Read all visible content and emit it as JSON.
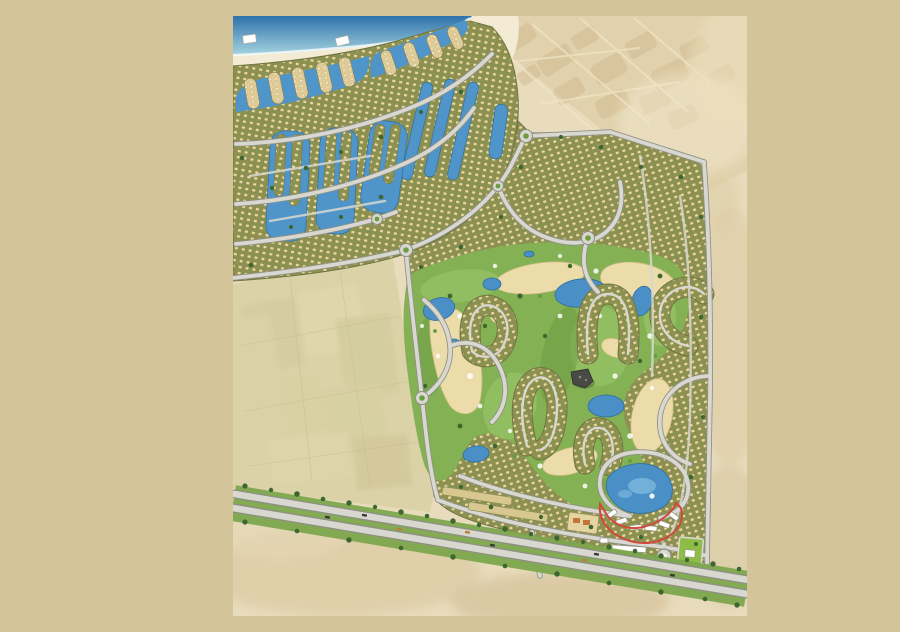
{
  "scene": {
    "type": "illustrated-masterplan-map",
    "description": "Painted aerial master plan of a coastal golf-resort community: beach and lagoon villages at the north, a central golf course threaded through residential loops, vacant farmland to the west, desert around, a highway along the south edge and a red-outlined hotel crescent near the main entrance",
    "features": [
      {
        "id": "sea",
        "name": "sea"
      },
      {
        "id": "beach",
        "name": "beach"
      },
      {
        "id": "beach-cabanas",
        "name": "beach cabanas",
        "count": 2
      },
      {
        "id": "existing-development-faded",
        "name": "faded existing development"
      },
      {
        "id": "desert",
        "name": "desert"
      },
      {
        "id": "north-lagoon-village",
        "name": "north lagoon village"
      },
      {
        "id": "beach-lagoons",
        "name": "beach lagoons with finger homes"
      },
      {
        "id": "marina-strip-lagoons",
        "name": "diagonal marina strip lagoons",
        "count": 3
      },
      {
        "id": "south-lagoon-clusters",
        "name": "south lagoon clusters",
        "count": 3
      },
      {
        "id": "vacant-farmland",
        "name": "vacant farmland"
      },
      {
        "id": "main-residential-district",
        "name": "main residential district"
      },
      {
        "id": "residential-loops",
        "name": "residential horseshoe loops"
      },
      {
        "id": "golf-course",
        "name": "golf course"
      },
      {
        "id": "golf-sand-waste",
        "name": "golf sand waste areas"
      },
      {
        "id": "golf-lakes",
        "name": "golf lakes"
      },
      {
        "id": "clubhouse",
        "name": "clubhouse"
      },
      {
        "id": "road-network",
        "name": "internal road network"
      },
      {
        "id": "roundabouts",
        "name": "roundabouts",
        "count": 6
      },
      {
        "id": "coastal-highway",
        "name": "coastal highway with tree rows"
      },
      {
        "id": "entrance-roundabout",
        "name": "entrance roundabout"
      },
      {
        "id": "hotel-crescent-highlight",
        "name": "red-outlined hotel crescent"
      },
      {
        "id": "resort-pool-lagoon",
        "name": "resort pool lagoon"
      },
      {
        "id": "community-park",
        "name": "community park"
      }
    ]
  },
  "palette": {
    "margin": "#d3c49a",
    "desertLight": "#e8dcbc",
    "desertMid": "#dcc9a0",
    "desertShadow": "#cdb88c",
    "beachSand": "#f3ebd4",
    "seaDeep": "#2d72aa",
    "seaShallow": "#a6d4e0",
    "lagoon": "#4f95c9",
    "lake": "#4a90c6",
    "lakeLight": "#7ab6dc",
    "lakeEdge": "#2f6e9e",
    "olive": "#8b9150",
    "oliveEdge": "#6f7440",
    "houseDot": "#ecd9a0",
    "fingerSand": "#e0cc97",
    "fingerDot": "#f4e7bf",
    "roadFill": "#d8d8d0",
    "roadEdge": "#8f8f86",
    "golf": "#83b153",
    "golfLight": "#98c468",
    "golfDark": "#6c9c43",
    "sandWaste": "#ebdcaa",
    "sandWasteEdge": "#cdbb80",
    "treeDark": "#3c672f",
    "treeLight": "#649a44",
    "redOutline": "#cf4a3a",
    "parkGreen": "#8fbc46",
    "clubhouse": "#4a4a45",
    "fadedDev": "#dfcfa8",
    "fadedBlock": "#c9ad7e",
    "highwayGreen": "#7ca64d",
    "vacant": "#dcd2a8",
    "carDark": "#3a3a38",
    "carOrange": "#c07a3a"
  }
}
